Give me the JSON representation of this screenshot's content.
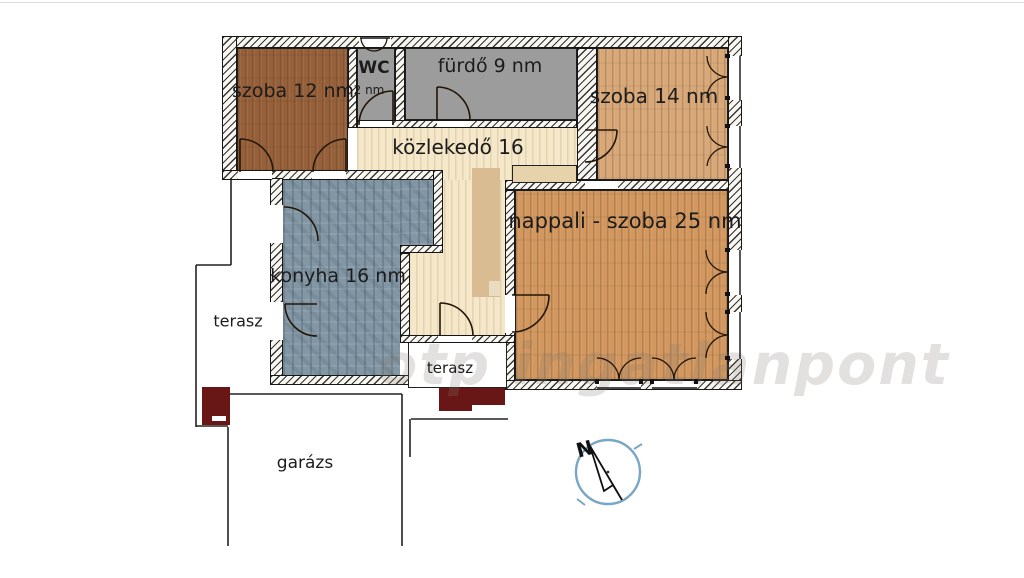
{
  "rooms": {
    "szoba12": "szoba 12 nm",
    "wc": "WC",
    "wc_area": "2 nm",
    "furdo": "fürdő 9 nm",
    "szoba14": "szoba 14 nm",
    "kozlekedo": "közlekedő 16",
    "nappali": "nappali - szoba 25 nm",
    "konyha": "konyha 16 nm",
    "terasz_bal": "terasz",
    "terasz_kozep": "terasz",
    "garazs": "garázs"
  },
  "compass": {
    "north": "N"
  },
  "watermark": "otp ingatlanpont",
  "colors": {
    "room_szoba12": "#96613a",
    "room_wet": "#9c9c9c",
    "room_szoba14": "#d8a878",
    "room_nappali": "#d2985f",
    "room_kozlekedo": "#f4e7ca",
    "room_konyha": "#8296a4",
    "cabinet_tan": "#d9bc92",
    "sideboard_tan": "#e6d2ab",
    "accent_dark_red": "#691716",
    "compass_blue": "#7aa6c6"
  }
}
